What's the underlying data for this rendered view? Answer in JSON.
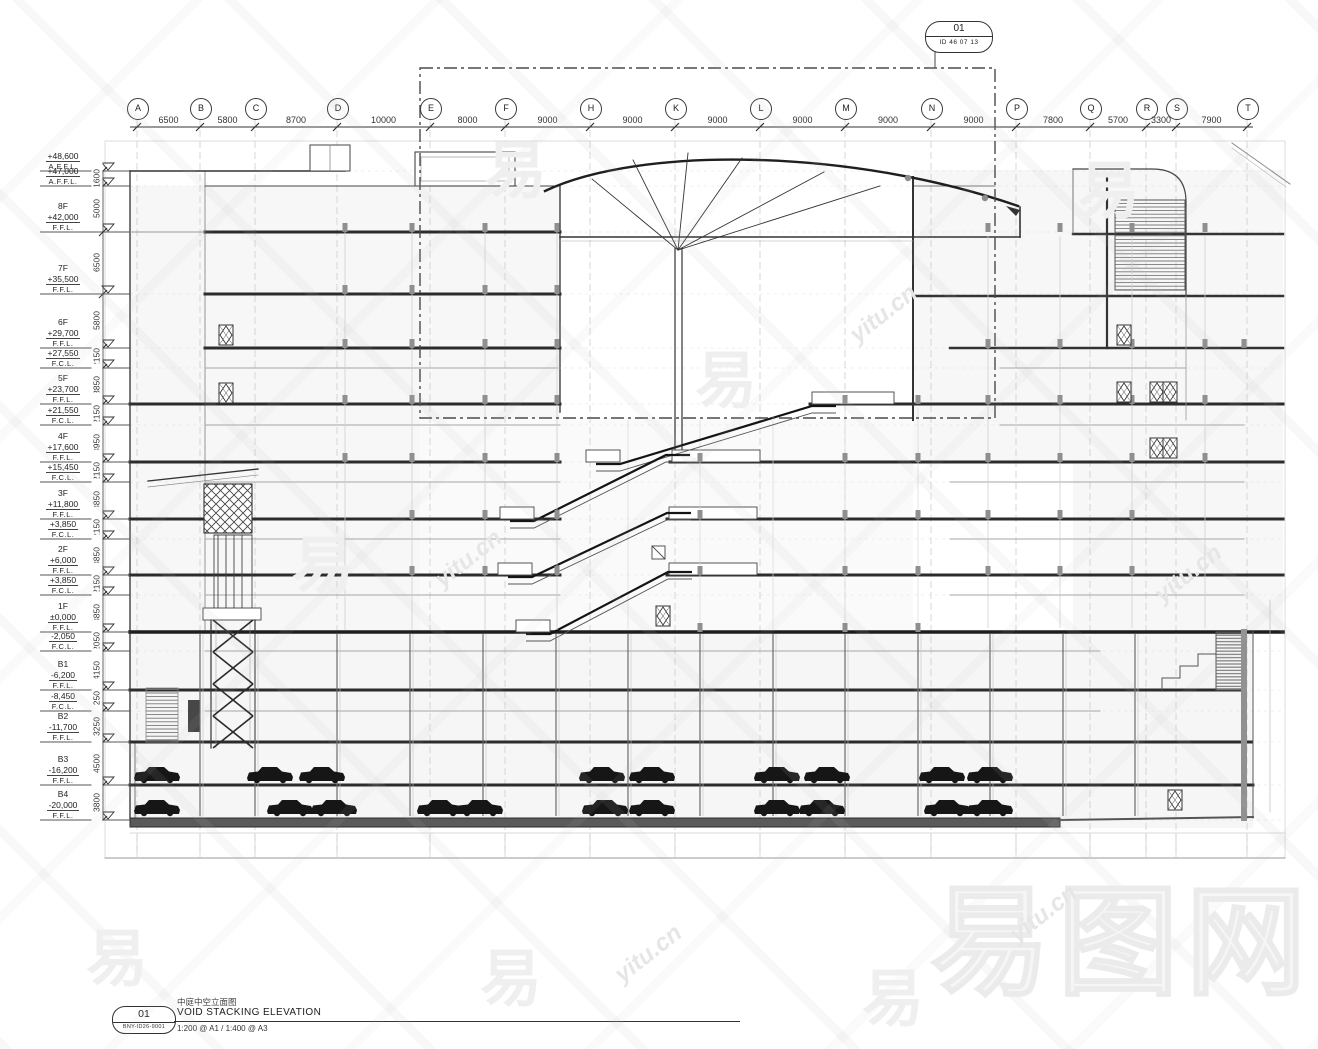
{
  "callout": {
    "number": "01",
    "id": "ID 46 07 13"
  },
  "top_grid": {
    "columns": [
      {
        "label": "A"
      },
      {
        "label": "B"
      },
      {
        "label": "C"
      },
      {
        "label": "D"
      },
      {
        "label": "E"
      },
      {
        "label": "F"
      },
      {
        "label": "H"
      },
      {
        "label": "K"
      },
      {
        "label": "L"
      },
      {
        "label": "M"
      },
      {
        "label": "N"
      },
      {
        "label": "P"
      },
      {
        "label": "Q"
      },
      {
        "label": "R"
      },
      {
        "label": "S"
      },
      {
        "label": "T"
      }
    ],
    "spacings": [
      "6500",
      "5800",
      "8700",
      "10000",
      "8000",
      "9000",
      "9000",
      "9000",
      "9000",
      "9000",
      "9000",
      "7800",
      "5700",
      "3300",
      "7900"
    ]
  },
  "levels": {
    "entries": [
      {
        "name": "",
        "value": "+48,600",
        "datum": "A.F.F.L."
      },
      {
        "name": "",
        "value": "+47,000",
        "datum": "A.F.F.L."
      },
      {
        "name": "8F",
        "value": "+42,000",
        "datum": "F.F.L."
      },
      {
        "name": "7F",
        "value": "+35,500",
        "datum": "F.F.L."
      },
      {
        "name": "6F",
        "value": "+29,700",
        "datum": "F.F.L."
      },
      {
        "name": "",
        "value": "+27,550",
        "datum": "F.C.L."
      },
      {
        "name": "5F",
        "value": "+23,700",
        "datum": "F.F.L."
      },
      {
        "name": "",
        "value": "+21,550",
        "datum": "F.C.L."
      },
      {
        "name": "4F",
        "value": "+17,600",
        "datum": "F.F.L."
      },
      {
        "name": "",
        "value": "+15,450",
        "datum": "F.C.L."
      },
      {
        "name": "3F",
        "value": "+11,800",
        "datum": "F.F.L."
      },
      {
        "name": "",
        "value": "+3,850",
        "datum": "F.C.L."
      },
      {
        "name": "2F",
        "value": "+6,000",
        "datum": "F.F.L."
      },
      {
        "name": "",
        "value": "+3,850",
        "datum": "F.C.L."
      },
      {
        "name": "1F",
        "value": "±0,000",
        "datum": "F.F.L."
      },
      {
        "name": "",
        "value": "-2,050",
        "datum": "F.C.L."
      },
      {
        "name": "B1",
        "value": "-6,200",
        "datum": "F.F.L."
      },
      {
        "name": "",
        "value": "-8,450",
        "datum": "F.C.L."
      },
      {
        "name": "B2",
        "value": "-11,700",
        "datum": "F.F.L."
      },
      {
        "name": "B3",
        "value": "-16,200",
        "datum": "F.F.L."
      },
      {
        "name": "B4",
        "value": "-20,000",
        "datum": "F.F.L."
      }
    ],
    "spacings": [
      "1600",
      "5000",
      "6500",
      "5800",
      "2150",
      "3850",
      "2150",
      "3950",
      "2150",
      "3850",
      "2150",
      "3850",
      "2150",
      "3850",
      "2050",
      "4150",
      "2250",
      "3250",
      "4500",
      "3800"
    ]
  },
  "title_block": {
    "number": "01",
    "drawing_no": "BNY-ID26-9001",
    "title_cn": "中庭中空立面图",
    "title_en": "VOID STACKING ELEVATION",
    "scale": "1:200 @ A1 / 1:400 @ A3"
  },
  "watermark": {
    "brand": "易图网",
    "domain": "yitu.cn",
    "glyph": "易"
  }
}
